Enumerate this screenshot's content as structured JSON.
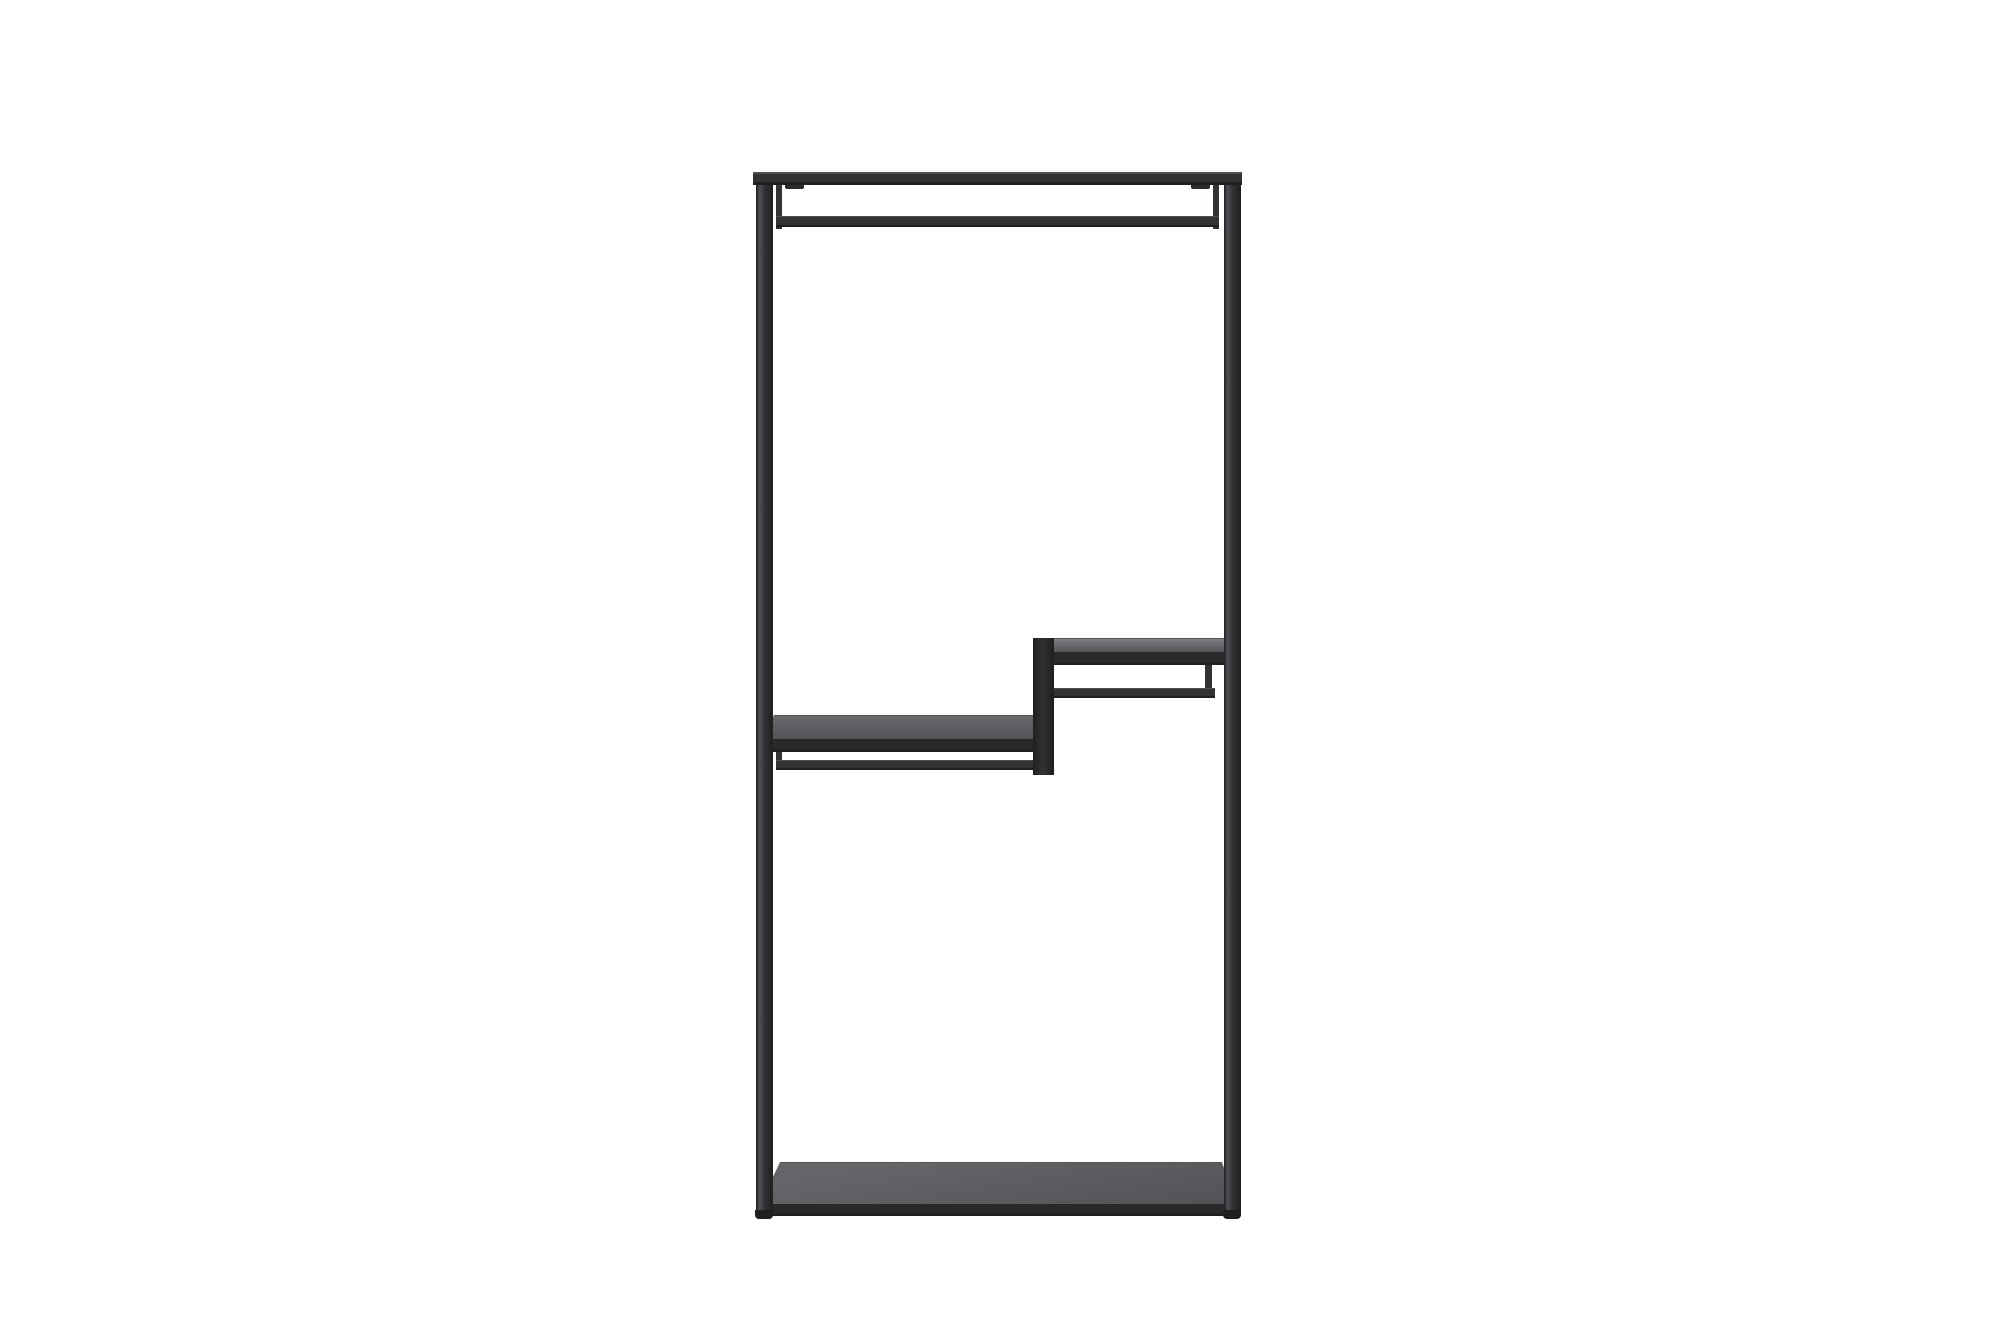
{
  "meta": {
    "type": "product-photo",
    "description": "Black metal open-frame wall clothes rack with a top hanging rail, two staggered middle shelves (right shelf higher, left shelf lower) each with a secondary rail beneath, a vertical step panel joining them, and a solid base shelf, photographed on a plain white background."
  },
  "colors": {
    "background": "#ffffff",
    "frame_dark": "#1e1f21",
    "frame_mid": "#303234",
    "frame_light": "#4e5154",
    "edge_black": "#28292b",
    "upper_shelf_gray": "#7b7d80",
    "lower_shelf_gray": "#67696c",
    "base_shelf_gray": "#636568",
    "shelf_gray_shade": "#525457"
  },
  "parts": {
    "photo": "Product photo of a black metal clothes rack",
    "rack": "Black metal clothes rack frame",
    "left_post": "Left upright post",
    "right_post": "Right upright post",
    "top_bar": "Top cross bar",
    "hanging_rail": "Clothes hanging rail",
    "rail_hanger_left": "Left rail hanger",
    "rail_hanger_right": "Right rail hanger",
    "rail_clip_left": "Left mounting clip",
    "rail_clip_right": "Right mounting clip",
    "step_panel": "Vertical step panel between shelves",
    "upper_shelf_top": "Upper right shelf surface",
    "upper_shelf_front": "Upper right shelf front edge",
    "upper_shelf_rail": "Rail under upper right shelf",
    "upper_shelf_rail_stub": "Upper shelf rail support stub",
    "lower_shelf_top": "Lower left shelf surface",
    "lower_shelf_front": "Lower left shelf front edge",
    "lower_shelf_rail": "Rail under lower left shelf",
    "lower_shelf_rail_stub": "Lower shelf rail support stub",
    "base_shelf_top": "Base shelf surface",
    "base_shelf_front": "Base shelf front edge",
    "foot_left": "Left foot",
    "foot_right": "Right foot"
  }
}
